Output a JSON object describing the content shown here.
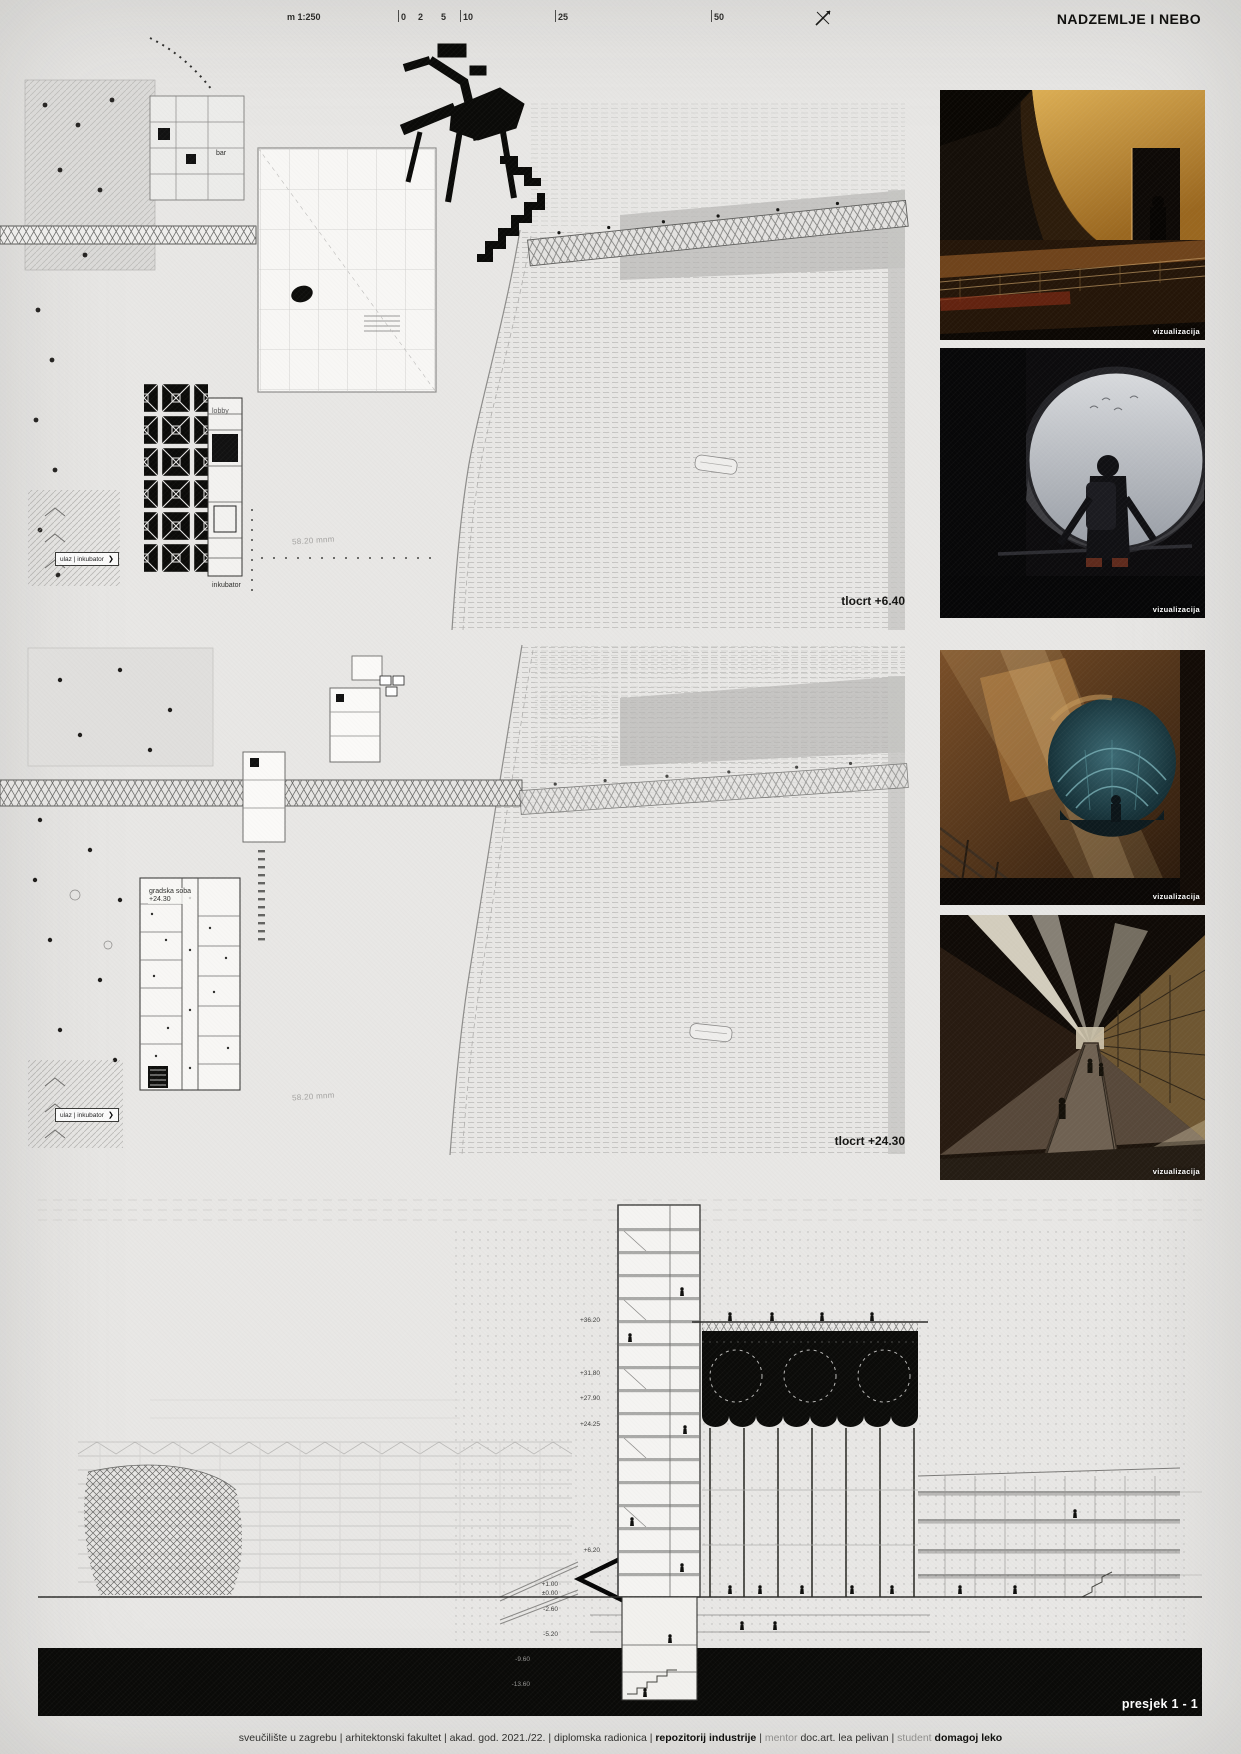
{
  "header": {
    "scale_label": "m 1:250",
    "scale_ticks": [
      "0",
      "2",
      "5",
      "10",
      "25",
      "50"
    ],
    "title": "NADZEMLJE I NEBO"
  },
  "plan_top": {
    "level_label": "tlocrt +6.40",
    "bar_label": "bar",
    "lobby_label": "lobby",
    "incubator_label": "inkubator",
    "entrance_label": "ulaz | inkubator",
    "entrance_arrow": "❯",
    "river_elevation": "58.20 mnm"
  },
  "plan_mid": {
    "level_label": "tlocrt +24.30",
    "room_label": "gradska soba",
    "room_level": "+24.30",
    "entrance_label": "ulaz | inkubator",
    "entrance_arrow": "❯",
    "river_elevation": "58.20 mnm"
  },
  "photos": [
    {
      "caption": "vizualizacija"
    },
    {
      "caption": "vizualizacija"
    },
    {
      "caption": "vizualizacija"
    },
    {
      "caption": "vizualizacija"
    }
  ],
  "section": {
    "label": "presjek 1 - 1",
    "elevations": [
      "+36.20",
      "+31.80",
      "+27.90",
      "+24.25",
      "+6.20",
      "+1.00",
      "±0.00",
      "-2.60",
      "-5.20",
      "-9.60",
      "-13.60"
    ]
  },
  "footer": {
    "parts": [
      {
        "text": "sveučilište u zagrebu | arhitektonski fakultet | akad. god. 2021./22. | diplomska radionica | ",
        "style": "normal"
      },
      {
        "text": "repozitorij industrije",
        "style": "bold"
      },
      {
        "text": " | ",
        "style": "normal"
      },
      {
        "text": "mentor ",
        "style": "muted"
      },
      {
        "text": "doc.art. lea pelivan",
        "style": "normal"
      },
      {
        "text": " | ",
        "style": "normal"
      },
      {
        "text": "student ",
        "style": "muted"
      },
      {
        "text": "domagoj leko",
        "style": "bold"
      }
    ]
  },
  "colors": {
    "paper": "#e8e7e5",
    "ink": "#111111",
    "muted": "#8f8e8c",
    "photo_caption": "#ffffff"
  }
}
